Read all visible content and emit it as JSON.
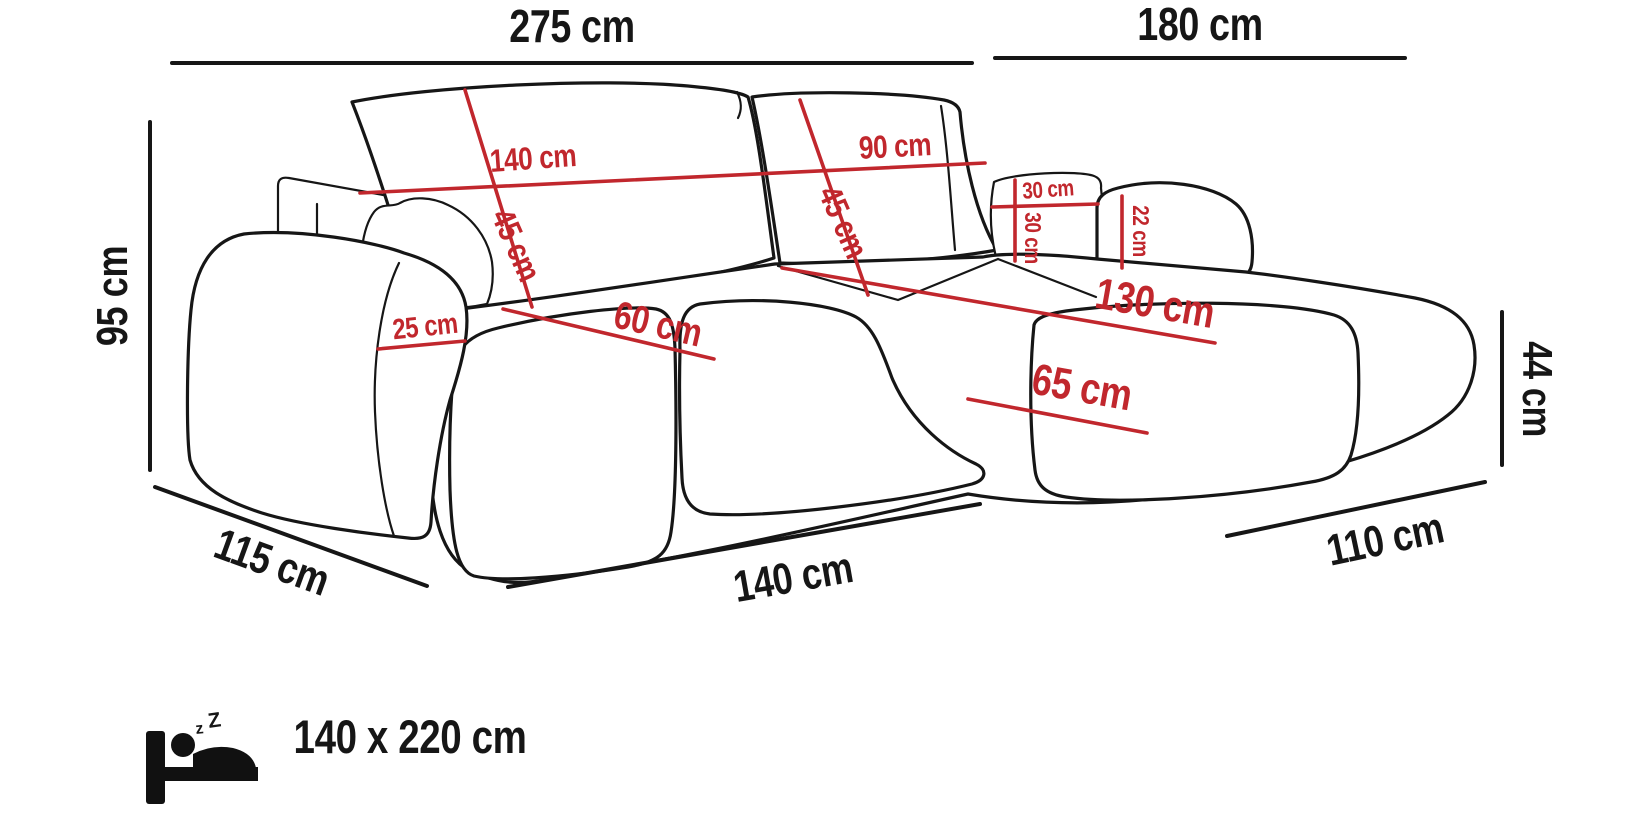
{
  "title": "Corner sofa dimension diagram",
  "units": "cm",
  "colors": {
    "dimension_red": "#c1272d",
    "line_black": "#161616",
    "background": "#ffffff"
  },
  "dimensions": {
    "total_width": {
      "label": "275 cm",
      "value": 275
    },
    "chaise_total_depth": {
      "label": "180 cm",
      "value": 180
    },
    "overall_height": {
      "label": "95 cm",
      "value": 95
    },
    "backrest_left_width": {
      "label": "140 cm",
      "value": 140
    },
    "backrest_right_width": {
      "label": "90 cm",
      "value": 90
    },
    "backrest_left_height": {
      "label": "45 cm",
      "value": 45
    },
    "backrest_right_height": {
      "label": "45 cm",
      "value": 45
    },
    "armrest_top_width": {
      "label": "25 cm",
      "value": 25
    },
    "seat_cushion_depth": {
      "label": "60 cm",
      "value": 60
    },
    "pillow_width": {
      "label": "30 cm",
      "value": 30
    },
    "pillow_height": {
      "label": "30 cm",
      "value": 30
    },
    "chaise_armrest_height": {
      "label": "22 cm",
      "value": 22
    },
    "chaise_seat_length": {
      "label": "130 cm",
      "value": 130
    },
    "chaise_seat_width": {
      "label": "65 cm",
      "value": 65
    },
    "seat_height": {
      "label": "44 cm",
      "value": 44
    },
    "side_depth": {
      "label": "115 cm",
      "value": 115
    },
    "front_seat_width": {
      "label": "140 cm",
      "value": 140
    },
    "chaise_front_depth": {
      "label": "110 cm",
      "value": 110
    }
  },
  "sleeping_area": {
    "label": "140 x 220 cm",
    "icon": "sleeping-bed-icon",
    "z_small": "z",
    "z_big": "Z"
  }
}
